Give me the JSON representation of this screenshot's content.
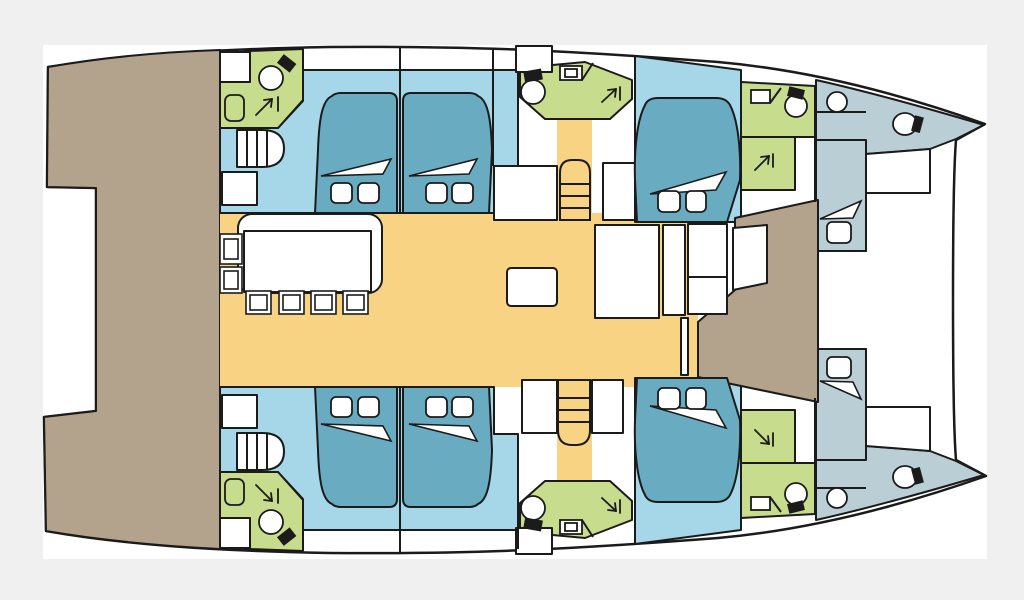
{
  "diagram": {
    "type": "yacht-deck-plan",
    "subject": "catamaran interior layout, top view, bows pointing right",
    "palette": {
      "frame_bg": "#f0f0f1",
      "paper": "#ffffff",
      "line": "#1b1b1b",
      "aft_deck": "#b4a38c",
      "salon_floor": "#f9d384",
      "cabin_floor": "#a6d7e8",
      "bed": "#69acc1",
      "bathroom": "#c8dc8e",
      "crew_area": "#b9ced5"
    },
    "areas": {
      "aft_platform": "aft deck / cockpit platform (taupe, left)",
      "salon": "central salon and galley (yellow floor)",
      "guest_cabins": "four double cabins amidships (light blue floors)",
      "forward_cockpit": "forward cockpit (taupe, center right) with door panel",
      "crew_cabins": "two forepeak crew cabins with single berths (gray-blue)",
      "bathrooms": "six heads/shower compartments (green)"
    },
    "fixtures": {
      "double_beds": 6,
      "single_berths": 2,
      "toilets": 8,
      "sinks": 8,
      "shower_symbols": 6,
      "dining_chairs": 4,
      "side_seats": 2,
      "stairways": 4,
      "dining_table": 1,
      "coffee_table": 1,
      "galley_blocks": 5,
      "foredeck_lockers": 2
    }
  }
}
